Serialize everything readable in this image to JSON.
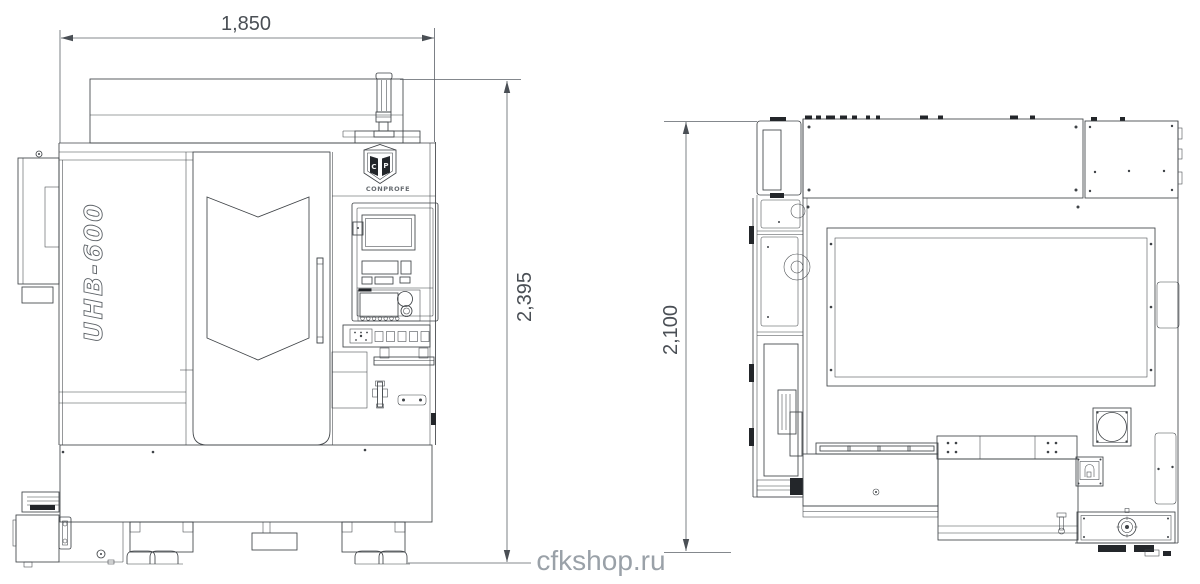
{
  "watermark": {
    "text": "cfkshop.ru"
  },
  "front_view": {
    "brand": "CONPROFE",
    "logo": {
      "left": "C",
      "right": "P"
    },
    "model": "UHB-600",
    "dim_width": "1,850",
    "dim_height": "2,395"
  },
  "side_view": {
    "dim_height": "2,100"
  },
  "colors": {
    "line": "#3f4347",
    "dimension": "#4a4f55",
    "watermark": "#9aa1a8",
    "key_fill": "#222222",
    "paper": "#ffffff"
  }
}
